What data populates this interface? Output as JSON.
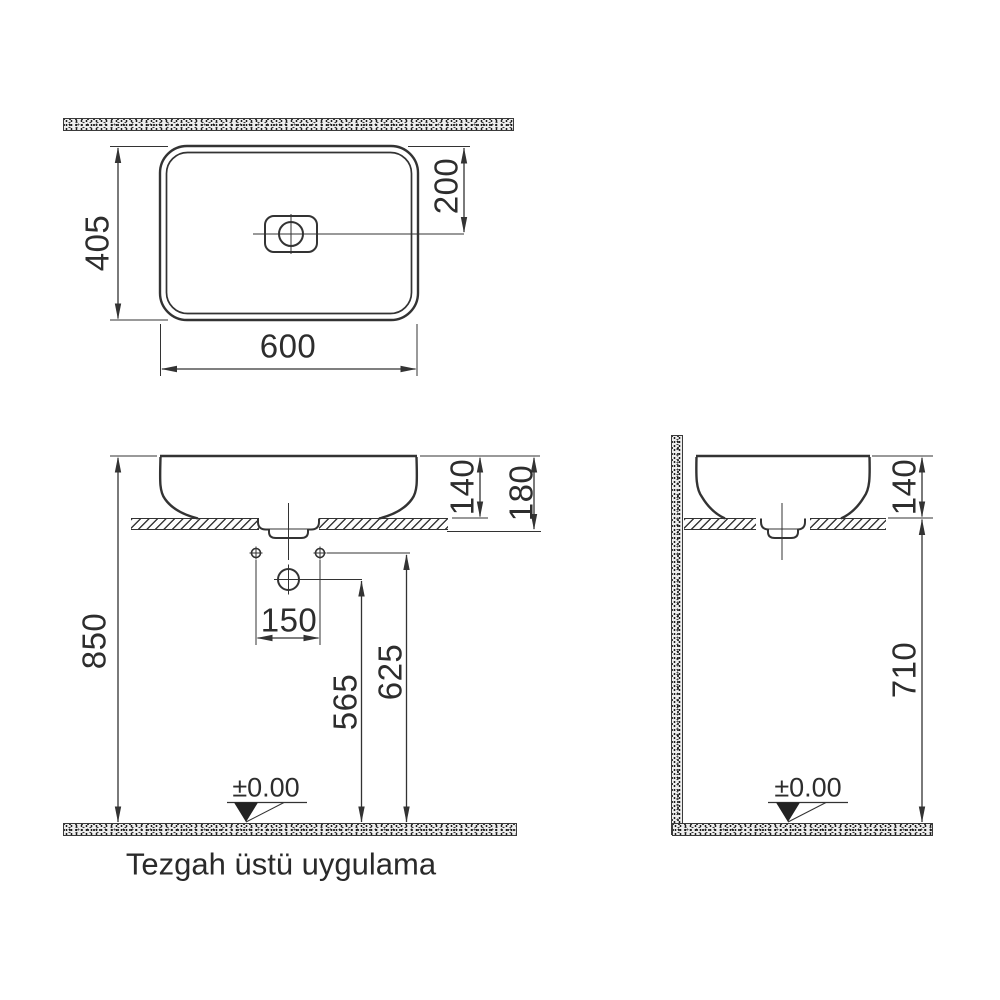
{
  "meta": {
    "caption": "Tezgah üstü uygulama",
    "line_color": "#333333",
    "text_color": "#2d2d2d"
  },
  "top_view": {
    "dim_depth": "405",
    "dim_width": "600",
    "dim_tap_offset": "200"
  },
  "front_view": {
    "dim_total_height": "850",
    "dim_rim_above_counter": "140",
    "dim_rim_to_counter_bottom": "180",
    "dim_hole_spacing": "150",
    "dim_supply_height": "565",
    "dim_holes_height": "625",
    "datum_level": "±0.00"
  },
  "side_view": {
    "dim_rim_above_counter": "140",
    "dim_counter_height": "710",
    "datum_level": "±0.00"
  }
}
